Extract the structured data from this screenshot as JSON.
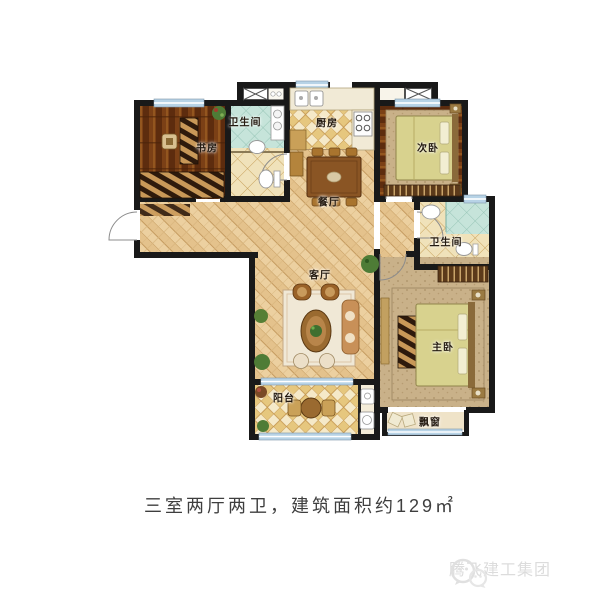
{
  "floorplan": {
    "rooms": {
      "study": "书房",
      "bathroom_top": "卫生间",
      "kitchen": "厨房",
      "bedroom2": "次卧",
      "dining": "餐厅",
      "living": "客厅",
      "bathroom_right": "卫生间",
      "master": "主卧",
      "balcony": "阳台",
      "bay_window": "飘窗"
    }
  },
  "summary": {
    "layout": "三室两厅两卫",
    "area": "建筑面积约129㎡",
    "full": "三室两厅两卫，建筑面积约129㎡"
  },
  "watermark": {
    "brand": "腾飞建工集团",
    "logo": "chat-bubbles-icon"
  },
  "colors": {
    "wall": "#191919",
    "wood_dark": "#6e3a16",
    "parquet": "#e9cfa0",
    "tile": "#f3e7c6",
    "teal": "#c6e4da",
    "carpet": "#c9b189",
    "window_blue": "#b7d3e6",
    "caption_text": "#3e3e3e",
    "watermark_gray": "#dcdcdc"
  }
}
